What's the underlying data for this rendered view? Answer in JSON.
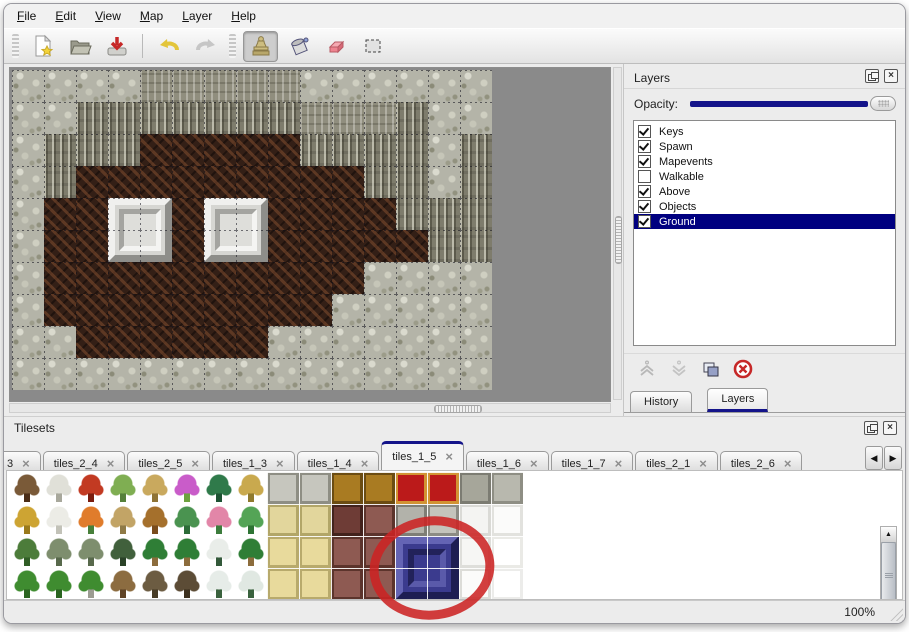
{
  "menu": {
    "items": [
      "File",
      "Edit",
      "View",
      "Map",
      "Layer",
      "Help"
    ]
  },
  "toolbar": {
    "buttons": [
      "new",
      "open",
      "save",
      "undo",
      "redo",
      "stamp",
      "fill",
      "eraser",
      "select"
    ],
    "active_tool": "stamp"
  },
  "layers_panel": {
    "title": "Layers",
    "opacity_label": "Opacity:",
    "layers": [
      {
        "name": "Keys",
        "checked": true,
        "selected": false
      },
      {
        "name": "Spawn",
        "checked": true,
        "selected": false
      },
      {
        "name": "Mapevents",
        "checked": true,
        "selected": false
      },
      {
        "name": "Walkable",
        "checked": false,
        "selected": false
      },
      {
        "name": "Above",
        "checked": true,
        "selected": false
      },
      {
        "name": "Objects",
        "checked": true,
        "selected": false
      },
      {
        "name": "Ground",
        "checked": true,
        "selected": true
      }
    ],
    "tabs": [
      {
        "label": "History",
        "active": false
      },
      {
        "label": "Layers",
        "active": true
      }
    ]
  },
  "tilesets_panel": {
    "title": "Tilesets",
    "tabs": [
      {
        "label": "3",
        "active": false,
        "partial": true
      },
      {
        "label": "tiles_2_4",
        "active": false
      },
      {
        "label": "tiles_2_5",
        "active": false
      },
      {
        "label": "tiles_1_3",
        "active": false
      },
      {
        "label": "tiles_1_4",
        "active": false
      },
      {
        "label": "tiles_1_5",
        "active": true
      },
      {
        "label": "tiles_1_6",
        "active": false
      },
      {
        "label": "tiles_1_7",
        "active": false
      },
      {
        "label": "tiles_2_1",
        "active": false
      },
      {
        "label": "tiles_2_6",
        "active": false
      }
    ],
    "close_glyph": "×",
    "scroll_left_glyph": "◀",
    "scroll_right_glyph": "▶",
    "scroll_up_glyph": "▲",
    "scroll_down_glyph": "▼"
  },
  "map": {
    "tile_size": 32,
    "legend": {
      "R": "light-rock",
      "T": "cliff-top",
      "C": "cliff-face",
      "F": "brown-floor"
    },
    "grid_rows": [
      "RRRRTTTTTRRRRRR",
      "RRCCCCCCCTTTCRR",
      "RCCCFFFFFCCCCRC",
      "RCFFFFFFFFFCCRC",
      "RFFFFFFFFFFFCCC",
      "RFFFFFFFFFFFFCC",
      "RFFFFFFFFFFRRRR",
      "RFFFFFFFFFRRRRR",
      "RRFFFFFFRRRRRRR",
      "RRRRRRRRRRRRRRR"
    ],
    "blocks": [
      {
        "col": 3,
        "row": 4
      },
      {
        "col": 6,
        "row": 4
      }
    ]
  },
  "tileset_grid": {
    "cols": 16,
    "rows": 4,
    "tile_size": 32,
    "highlight_block": {
      "col": 12,
      "row": 2,
      "color": "#3b3b8e"
    },
    "cells": [
      [
        {
          "t": "plant",
          "a": "#7a5a38",
          "b": "#4a2c16"
        },
        {
          "t": "plant",
          "a": "#e0e0d8",
          "b": "#a8a89c"
        },
        {
          "t": "plant",
          "a": "#c23a22",
          "b": "#7a1c0e"
        },
        {
          "t": "plant",
          "a": "#7fae52",
          "b": "#55803a"
        },
        {
          "t": "plant",
          "a": "#c9a95e",
          "b": "#8f7436"
        },
        {
          "t": "plant",
          "a": "#c95cc9",
          "b": "#6da23e"
        },
        {
          "t": "plant",
          "a": "#2f7a4a",
          "b": "#1c5232"
        },
        {
          "t": "plant",
          "a": "#c9a94e",
          "b": "#8f7a2e"
        },
        {
          "t": "flat",
          "a": "#c6c6be",
          "b": "#8e8e84"
        },
        {
          "t": "flat",
          "a": "#c6c6be",
          "b": "#8e8e84"
        },
        {
          "t": "flat",
          "a": "#a97b22",
          "b": "#6b4c12"
        },
        {
          "t": "flat",
          "a": "#a97b22",
          "b": "#6b4c12"
        },
        {
          "t": "flat",
          "a": "#bb1a1a",
          "b": "#d29333"
        },
        {
          "t": "flat",
          "a": "#bb1a1a",
          "b": "#d29333"
        },
        {
          "t": "flat",
          "a": "#a6a69a",
          "b": "#7c7c72"
        },
        {
          "t": "flat",
          "a": "#b8b8ae",
          "b": "#8e8e84"
        }
      ],
      [
        {
          "t": "plant",
          "a": "#cda433",
          "b": "#9a7a1c"
        },
        {
          "t": "plant",
          "a": "#ecece6",
          "b": "#c2c2b8"
        },
        {
          "t": "plant",
          "a": "#e07c2c",
          "b": "#47803a"
        },
        {
          "t": "plant",
          "a": "#c2a466",
          "b": "#8f7a46"
        },
        {
          "t": "plant",
          "a": "#a5702c",
          "b": "#7a4c1c"
        },
        {
          "t": "plant",
          "a": "#4a9350",
          "b": "#2c6c38"
        },
        {
          "t": "plant",
          "a": "#e286a8",
          "b": "#3c7c3c"
        },
        {
          "t": "plant",
          "a": "#54a456",
          "b": "#2e7434"
        },
        {
          "t": "flat",
          "a": "#e2d69c",
          "b": "#b2a668"
        },
        {
          "t": "flat",
          "a": "#e2d69c",
          "b": "#b2a668"
        },
        {
          "t": "flat",
          "a": "#6e3c36",
          "b": "#42221c"
        },
        {
          "t": "flat",
          "a": "#8e5a52",
          "b": "#5c342c"
        },
        {
          "t": "flat",
          "a": "#b2b2aa",
          "b": "#7e7e76"
        },
        {
          "t": "flat",
          "a": "#c4c4bc",
          "b": "#8c8c84"
        },
        {
          "t": "flat",
          "a": "#f4f4f2",
          "b": "#dadad6"
        },
        {
          "t": "flat",
          "a": "#fbfbfa",
          "b": "#e2e2de"
        }
      ],
      [
        {
          "t": "plant",
          "a": "#4c7c3a",
          "b": "#315e26"
        },
        {
          "t": "plant",
          "a": "#7e8e6e",
          "b": "#58694c"
        },
        {
          "t": "plant",
          "a": "#7e8e6e",
          "b": "#58694c"
        },
        {
          "t": "plant",
          "a": "#41603c",
          "b": "#2a4228"
        },
        {
          "t": "plant",
          "a": "#2f7e36",
          "b": "#8c6c3c"
        },
        {
          "t": "plant",
          "a": "#2f7e36",
          "b": "#8c6c3c"
        },
        {
          "t": "plant",
          "a": "#e9ede9",
          "b": "#33593a"
        },
        {
          "t": "plant",
          "a": "#2f7e36",
          "b": "#8c6c3c"
        },
        {
          "t": "flat",
          "a": "#e8da9c",
          "b": "#b8aa6c"
        },
        {
          "t": "flat",
          "a": "#e8da9c",
          "b": "#b8aa6c"
        },
        {
          "t": "flat",
          "a": "#8e5a52",
          "b": "#5c342c"
        },
        {
          "t": "flat",
          "a": "#8e5a52",
          "b": "#5c342c"
        },
        {
          "t": "flat",
          "a": "#3b3b8e",
          "b": "#23235e"
        },
        {
          "t": "flat",
          "a": "#3b3b8e",
          "b": "#23235e"
        },
        {
          "t": "flat",
          "a": "#f6f6f4",
          "b": "#dededa"
        },
        {
          "t": "flat",
          "a": "#ffffff",
          "b": "#eaeae6"
        }
      ],
      [
        {
          "t": "plant",
          "a": "#3f8c30",
          "b": "#2a6420"
        },
        {
          "t": "plant",
          "a": "#3f8c30",
          "b": "#2a6420"
        },
        {
          "t": "plant",
          "a": "#3f8c30",
          "b": "#9c9c92"
        },
        {
          "t": "plant",
          "a": "#8c6c40",
          "b": "#604426"
        },
        {
          "t": "plant",
          "a": "#6c5c42",
          "b": "#483c26"
        },
        {
          "t": "plant",
          "a": "#5c4c36",
          "b": "#3c301e"
        },
        {
          "t": "plant",
          "a": "#e6ece8",
          "b": "#3a623e"
        },
        {
          "t": "plant",
          "a": "#e0e8e2",
          "b": "#3a623e"
        },
        {
          "t": "flat",
          "a": "#e8da9c",
          "b": "#b8aa6c"
        },
        {
          "t": "flat",
          "a": "#e8da9c",
          "b": "#b8aa6c"
        },
        {
          "t": "flat",
          "a": "#8e5a52",
          "b": "#5c342c"
        },
        {
          "t": "flat",
          "a": "#8e5a52",
          "b": "#5c342c"
        },
        {
          "t": "flat",
          "a": "#3b3b8e",
          "b": "#23235e"
        },
        {
          "t": "flat",
          "a": "#3b3b8e",
          "b": "#23235e"
        },
        {
          "t": "flat",
          "a": "#fbfbfa",
          "b": "#dcdcd8"
        },
        {
          "t": "flat",
          "a": "#ffffff",
          "b": "#ececea"
        }
      ]
    ]
  },
  "annotation": {
    "shape": "ellipse",
    "color": "#cc2323"
  },
  "status": {
    "zoom": "100%"
  },
  "colors": {
    "selection": "#000080",
    "accent_navy": "#14148a",
    "canvas_bg": "#8a8a8a"
  }
}
